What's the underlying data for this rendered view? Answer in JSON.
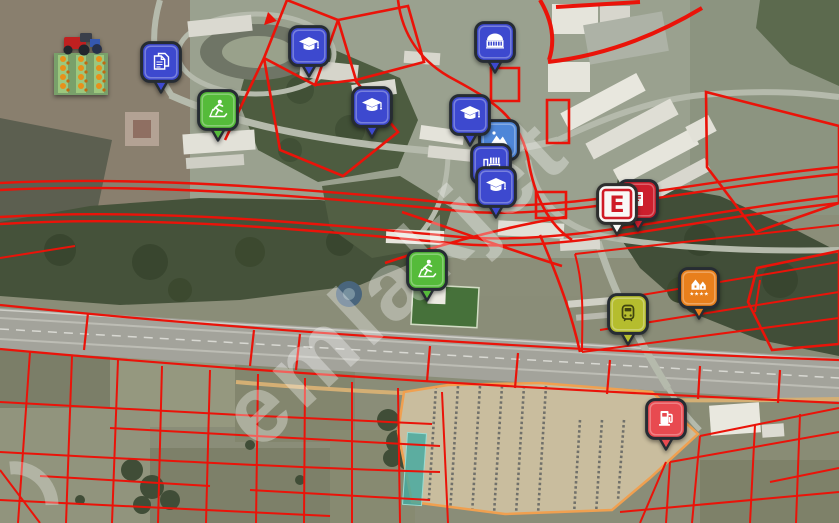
{
  "map": {
    "watermark": "emlakjet",
    "overlay": {
      "parcel_line_color": "#ea1309",
      "parking_outline_color": "#f0a050",
      "highlighted_parcel_color": "#44aaa0"
    },
    "markers": [
      {
        "name": "farm-photo",
        "icon": "farm-image-icon",
        "x": 81,
        "y": 65,
        "color": "#79a06a"
      },
      {
        "name": "document-office",
        "icon": "document-icon",
        "x": 161,
        "y": 62,
        "color": "#3d49cf"
      },
      {
        "name": "fitness-center-1",
        "icon": "treadmill-runner-icon",
        "x": 218,
        "y": 110,
        "color": "#55bb3a"
      },
      {
        "name": "school-1",
        "icon": "graduation-cap-icon",
        "x": 309,
        "y": 46,
        "color": "#3d49cf"
      },
      {
        "name": "school-2",
        "icon": "graduation-cap-icon",
        "x": 372,
        "y": 107,
        "color": "#3d49cf"
      },
      {
        "name": "event-hall",
        "icon": "dome-building-icon",
        "x": 495,
        "y": 42,
        "color": "#3d49cf"
      },
      {
        "name": "landscape-site",
        "icon": "landscape-icon",
        "x": 499,
        "y": 140,
        "color": "#4e86d8"
      },
      {
        "name": "industrial-site",
        "icon": "factory-icon",
        "x": 491,
        "y": 164,
        "color": "#3d49cf"
      },
      {
        "name": "school-4",
        "icon": "graduation-cap-icon",
        "x": 496,
        "y": 187,
        "color": "#3d49cf"
      },
      {
        "name": "school-3",
        "icon": "graduation-cap-icon",
        "x": 470,
        "y": 115,
        "color": "#3d49cf"
      },
      {
        "name": "prescription",
        "icon": "prescription-icon",
        "x": 638,
        "y": 200,
        "color": "#cc1f2d"
      },
      {
        "name": "pharmacy",
        "icon": "pharmacy-e-icon",
        "x": 617,
        "y": 204,
        "color": "#f8f8f6",
        "label": "E"
      },
      {
        "name": "fitness-center-2",
        "icon": "treadmill-runner-icon",
        "x": 427,
        "y": 270,
        "color": "#55bb3a"
      },
      {
        "name": "hotel",
        "icon": "hotel-stars-icon",
        "x": 699,
        "y": 288,
        "color": "#e87f1c",
        "stars": 4
      },
      {
        "name": "train-station",
        "icon": "train-icon",
        "x": 628,
        "y": 314,
        "color": "#b5bd2e"
      },
      {
        "name": "fuel-station",
        "icon": "fuel-pump-icon",
        "x": 666,
        "y": 419,
        "color": "#e84a50"
      }
    ]
  }
}
